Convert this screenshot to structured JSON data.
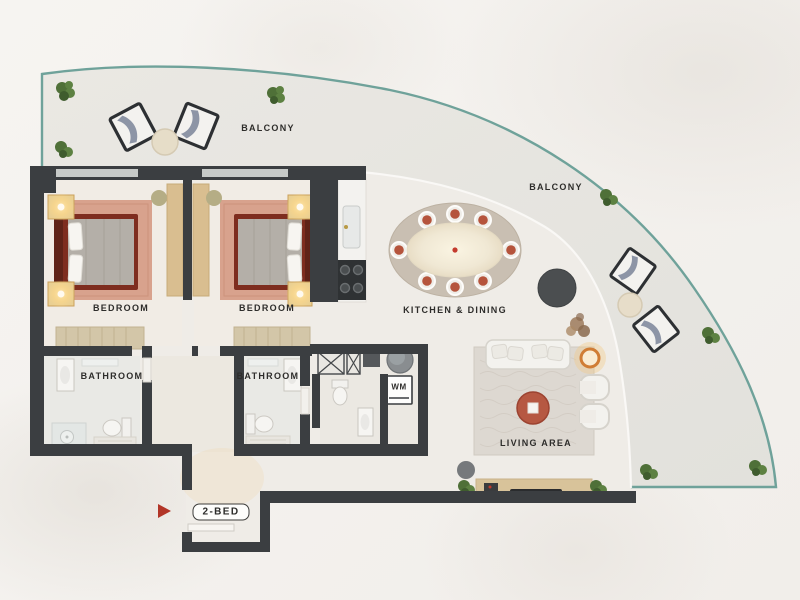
{
  "plan": {
    "unit_badge": "2-BED",
    "labels": {
      "balcony_top": "BALCONY",
      "balcony_right": "BALCONY",
      "bedroom_1": "BEDROOM",
      "bedroom_2": "BEDROOM",
      "bathroom_1": "BATHROOM",
      "bathroom_2": "BATHROOM",
      "kitchen_dining": "KITCHEN & DINING",
      "living_area": "LIVING AREA",
      "washer": "WM"
    }
  },
  "palette": {
    "background_marble": "#f4f2ef",
    "balcony_floor": "#e7e5e0",
    "interior_floor": "#efece7",
    "wall": "#3b3e41",
    "balcony_edge_teal": "#6fa29a",
    "entry_arrow_red": "#b23527",
    "bed_frame_maroon": "#7e2d1f",
    "bedroom_rug_salmon": "#d8a28d",
    "dining_chair_red": "#b5543c",
    "coffee_table_terracotta": "#b65842",
    "wood_light": "#d8c39a",
    "label_text": "#2e2d2b"
  }
}
